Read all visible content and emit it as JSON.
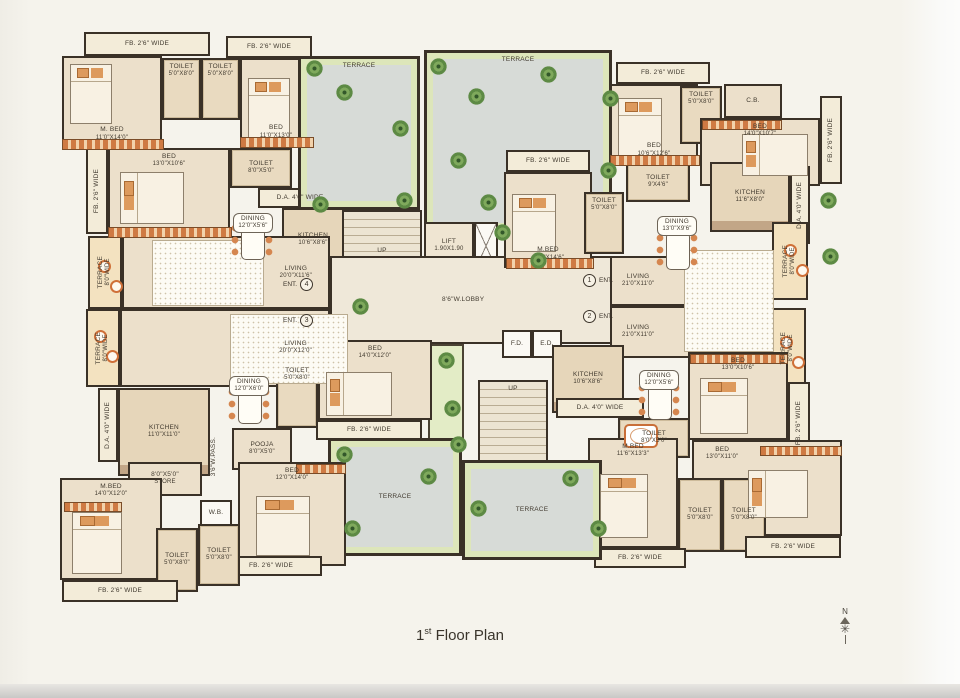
{
  "title": {
    "number": "1",
    "ordinal": "st",
    "text": " Floor Plan"
  },
  "compass": {
    "north": "N"
  },
  "colors": {
    "wall": "#3a3127",
    "floor": "#ece0cb",
    "terrace": "#d7dbd7",
    "green_trim": "#dde6ba",
    "accent": "#cf7038",
    "paper": "#f5f3ec"
  },
  "plan": {
    "rooms": [
      {
        "n": "fb-balcony",
        "a": "FB. 2'6\" WIDE",
        "x": 84,
        "y": 32,
        "w": 126,
        "h": 24,
        "k": "strip"
      },
      {
        "n": "fb-balcony",
        "a": "FB. 2'6\" WIDE",
        "x": 226,
        "y": 36,
        "w": 86,
        "h": 22,
        "k": "strip"
      },
      {
        "n": "master-bedroom",
        "a": "M. BED",
        "b": "11'0\"X14'0\"",
        "x": 62,
        "y": 56,
        "w": 100,
        "h": 92,
        "k": "room",
        "lp": "b"
      },
      {
        "n": "toilet",
        "a": "TOILET",
        "b": "5'0\"X8'0\"",
        "x": 162,
        "y": 58,
        "w": 39,
        "h": 62,
        "k": "wet",
        "lp": "t"
      },
      {
        "n": "toilet",
        "a": "TOILET",
        "b": "5'0\"X8'0\"",
        "x": 201,
        "y": 58,
        "w": 39,
        "h": 62,
        "k": "wet",
        "lp": "t"
      },
      {
        "n": "bedroom",
        "a": "BED",
        "b": "11'0\"X13'0\"",
        "x": 240,
        "y": 58,
        "w": 72,
        "h": 88,
        "k": "room",
        "lp": "b"
      },
      {
        "n": "fb-balcony",
        "a": "FB. 2'6\" WIDE",
        "x": 86,
        "y": 148,
        "w": 22,
        "h": 86,
        "k": "strip",
        "v": true
      },
      {
        "n": "bedroom",
        "a": "BED",
        "b": "13'0\"X10'6\"",
        "x": 108,
        "y": 148,
        "w": 122,
        "h": 88,
        "k": "room",
        "lp": "t"
      },
      {
        "n": "toilet",
        "a": "TOILET",
        "b": "8'0\"X5'0\"",
        "x": 230,
        "y": 148,
        "w": 62,
        "h": 40,
        "k": "wet"
      },
      {
        "n": "duct-area",
        "a": "D.A. 4'0\" WIDE",
        "x": 258,
        "y": 188,
        "w": 84,
        "h": 20,
        "k": "strip"
      },
      {
        "n": "kitchen",
        "a": "KITCHEN",
        "b": "10'6\"X8'6\"",
        "x": 282,
        "y": 208,
        "w": 62,
        "h": 64,
        "k": "kitchen"
      },
      {
        "n": "dining",
        "a": "DINING",
        "b": "12'0\"X5'6\"",
        "x": 224,
        "y": 208,
        "w": 58,
        "h": 30,
        "k": "open",
        "lb": true
      },
      {
        "n": "terrace-side",
        "a": "TERRACE",
        "b": "8'0\"WIDE",
        "x": 88,
        "y": 236,
        "w": 34,
        "h": 73,
        "k": "tstrip",
        "v": true
      },
      {
        "n": "living-room",
        "a": "LIVING",
        "b": "20'0\"X11'6\"",
        "x": 122,
        "y": 236,
        "w": 208,
        "h": 73,
        "k": "room",
        "lp": "r"
      },
      {
        "n": "terrace-side",
        "a": "TERRACE",
        "b": "8'0\"WIDE",
        "x": 86,
        "y": 309,
        "w": 34,
        "h": 78,
        "k": "tstrip",
        "v": true
      },
      {
        "n": "living-room",
        "a": "LIVING",
        "b": "20'0\"X12'0\"",
        "x": 120,
        "y": 309,
        "w": 210,
        "h": 78,
        "k": "room",
        "lp": "r"
      },
      {
        "n": "terrace",
        "a": "TERRACE",
        "x": 298,
        "y": 56,
        "w": 122,
        "h": 154,
        "k": "terrace",
        "lp": "t"
      },
      {
        "n": "terrace",
        "a": "TERRACE",
        "x": 424,
        "y": 50,
        "w": 188,
        "h": 182,
        "k": "terrace",
        "lp": "t"
      },
      {
        "n": "staircase",
        "a": "UP",
        "x": 342,
        "y": 210,
        "w": 80,
        "h": 82,
        "k": "stairs"
      },
      {
        "n": "lift",
        "a": "LIFT",
        "b": "1.90X1.90",
        "x": 424,
        "y": 222,
        "w": 50,
        "h": 48,
        "k": "lift"
      },
      {
        "n": "shaft",
        "a": "",
        "x": 474,
        "y": 222,
        "w": 24,
        "h": 48,
        "k": "shaft"
      },
      {
        "n": "lobby",
        "a": "8'6\"W.LOBBY",
        "x": 330,
        "y": 256,
        "w": 330,
        "h": 88,
        "k": "hall",
        "lp": "lob"
      },
      {
        "n": "fire-duct",
        "a": "F.D.",
        "x": 502,
        "y": 330,
        "w": 30,
        "h": 28,
        "k": "shaftl"
      },
      {
        "n": "electrical-duct",
        "a": "E.D.",
        "x": 532,
        "y": 330,
        "w": 30,
        "h": 28,
        "k": "shaftl"
      },
      {
        "n": "staircase",
        "a": "UP",
        "x": 478,
        "y": 380,
        "w": 70,
        "h": 92,
        "k": "stairs",
        "lp": "t"
      },
      {
        "n": "planter",
        "a": "",
        "x": 428,
        "y": 344,
        "w": 36,
        "h": 100,
        "k": "planter"
      },
      {
        "n": "fb-balcony",
        "a": "FB. 2'6\" WIDE",
        "x": 616,
        "y": 62,
        "w": 94,
        "h": 22,
        "k": "strip"
      },
      {
        "n": "bedroom",
        "a": "BED",
        "b": "10'6\"X12'6\"",
        "x": 610,
        "y": 84,
        "w": 88,
        "h": 80,
        "k": "room",
        "lp": "b"
      },
      {
        "n": "toilet",
        "a": "TOILET",
        "b": "5'0\"X8'0\"",
        "x": 680,
        "y": 86,
        "w": 42,
        "h": 58,
        "k": "wet",
        "lp": "t"
      },
      {
        "n": "cupboard",
        "a": "C.B.",
        "x": 724,
        "y": 84,
        "w": 58,
        "h": 34,
        "k": "room"
      },
      {
        "n": "bedroom",
        "a": "BED",
        "b": "14'0\"X10'7\"",
        "x": 700,
        "y": 118,
        "w": 120,
        "h": 68,
        "k": "room",
        "lp": "t"
      },
      {
        "n": "fb-balcony",
        "a": "FB. 2'6\" WIDE",
        "x": 820,
        "y": 96,
        "w": 22,
        "h": 88,
        "k": "strip",
        "v": true
      },
      {
        "n": "fb-balcony",
        "a": "FB. 2'6\" WIDE",
        "x": 506,
        "y": 150,
        "w": 84,
        "h": 22,
        "k": "strip"
      },
      {
        "n": "master-bedroom",
        "a": "M.BED",
        "b": "11'0\"X14'6\"",
        "x": 504,
        "y": 172,
        "w": 88,
        "h": 96,
        "k": "room",
        "lp": "b"
      },
      {
        "n": "toilet",
        "a": "TOILET",
        "b": "5'0\"X8'0\"",
        "x": 584,
        "y": 192,
        "w": 40,
        "h": 62,
        "k": "wet",
        "lp": "t"
      },
      {
        "n": "toilet",
        "a": "TOILET",
        "b": "9'X4'6\"",
        "x": 626,
        "y": 162,
        "w": 64,
        "h": 40,
        "k": "wet"
      },
      {
        "n": "kitchen",
        "a": "KITCHEN",
        "b": "11'6\"X8'0\"",
        "x": 710,
        "y": 162,
        "w": 80,
        "h": 70,
        "k": "kitchen"
      },
      {
        "n": "duct-area",
        "a": "D.A. 4'0\" WIDE",
        "x": 790,
        "y": 166,
        "w": 20,
        "h": 78,
        "k": "strip",
        "v": true
      },
      {
        "n": "dining",
        "a": "DINING",
        "b": "13'0\"X9'6\"",
        "x": 648,
        "y": 212,
        "w": 58,
        "h": 28,
        "k": "open",
        "lb": true
      },
      {
        "n": "terrace-side",
        "a": "TERRACE",
        "b": "8'0\"WIDE",
        "x": 772,
        "y": 222,
        "w": 36,
        "h": 78,
        "k": "tstrip",
        "v": true
      },
      {
        "n": "living-room",
        "a": "LIVING",
        "b": "21'0\"X11'0\"",
        "x": 610,
        "y": 256,
        "w": 162,
        "h": 50,
        "k": "room",
        "lp": "l"
      },
      {
        "n": "living-room",
        "a": "LIVING",
        "b": "21'0\"X11'0\"",
        "x": 610,
        "y": 306,
        "w": 162,
        "h": 52,
        "k": "room",
        "lp": "l"
      },
      {
        "n": "terrace-side",
        "a": "TERRACE",
        "b": "8'0\"WIDE",
        "x": 770,
        "y": 308,
        "w": 36,
        "h": 80,
        "k": "tstrip",
        "v": true
      },
      {
        "n": "kitchen",
        "a": "KITCHEN",
        "b": "10'6\"X8'6\"",
        "x": 552,
        "y": 345,
        "w": 72,
        "h": 68,
        "k": "kitchen"
      },
      {
        "n": "dining",
        "a": "DINING",
        "b": "12'0\"X5'6\"",
        "x": 630,
        "y": 366,
        "w": 58,
        "h": 28,
        "k": "open",
        "lb": true
      },
      {
        "n": "duct-area",
        "a": "D.A. 4'0\" WIDE",
        "x": 556,
        "y": 398,
        "w": 88,
        "h": 20,
        "k": "strip"
      },
      {
        "n": "toilet",
        "a": "TOILET",
        "b": "8'0\"X5'0\"",
        "x": 618,
        "y": 418,
        "w": 72,
        "h": 40,
        "k": "wet"
      },
      {
        "n": "bedroom",
        "a": "BED",
        "b": "13'0\"X10'6\"",
        "x": 688,
        "y": 352,
        "w": 100,
        "h": 88,
        "k": "room",
        "lp": "t"
      },
      {
        "n": "fb-balcony",
        "a": "FB. 2'6\" WIDE",
        "x": 788,
        "y": 382,
        "w": 22,
        "h": 82,
        "k": "strip",
        "v": true
      },
      {
        "n": "bedroom",
        "a": "BED",
        "b": "13'0\"X11'0\"",
        "x": 692,
        "y": 440,
        "w": 150,
        "h": 96,
        "k": "room",
        "lp": "tl"
      },
      {
        "n": "master-bedroom",
        "a": "M.BED",
        "b": "11'6\"X13'3\"",
        "x": 588,
        "y": 438,
        "w": 90,
        "h": 110,
        "k": "room",
        "lp": "t"
      },
      {
        "n": "toilet",
        "a": "TOILET",
        "b": "5'0\"X8'0\"",
        "x": 678,
        "y": 478,
        "w": 44,
        "h": 74,
        "k": "wet"
      },
      {
        "n": "toilet",
        "a": "TOILET",
        "b": "5'0\"X8'0\"",
        "x": 722,
        "y": 478,
        "w": 44,
        "h": 74,
        "k": "wet"
      },
      {
        "n": "fb-balcony",
        "a": "FB. 2'6\" WIDE",
        "x": 594,
        "y": 548,
        "w": 92,
        "h": 20,
        "k": "strip"
      },
      {
        "n": "fb-balcony",
        "a": "FB. 2'6\" WIDE",
        "x": 745,
        "y": 536,
        "w": 96,
        "h": 22,
        "k": "strip"
      },
      {
        "n": "terrace",
        "a": "TERRACE",
        "x": 328,
        "y": 438,
        "w": 134,
        "h": 118,
        "k": "terrace"
      },
      {
        "n": "terrace",
        "a": "TERRACE",
        "x": 462,
        "y": 460,
        "w": 140,
        "h": 100,
        "k": "terrace"
      },
      {
        "n": "bedroom",
        "a": "BED",
        "b": "14'0\"X12'0\"",
        "x": 318,
        "y": 340,
        "w": 114,
        "h": 80,
        "k": "room",
        "lp": "t"
      },
      {
        "n": "toilet",
        "a": "TOILET",
        "b": "5'0\"X8'0\"",
        "x": 276,
        "y": 362,
        "w": 42,
        "h": 66,
        "k": "wet",
        "lp": "t"
      },
      {
        "n": "fb-balcony",
        "a": "FB. 2'6\" WIDE",
        "x": 316,
        "y": 420,
        "w": 106,
        "h": 20,
        "k": "strip"
      },
      {
        "n": "dining",
        "a": "DINING",
        "b": "12'0\"X6'0\"",
        "x": 220,
        "y": 372,
        "w": 58,
        "h": 28,
        "k": "open",
        "lb": true
      },
      {
        "n": "kitchen",
        "a": "KITCHEN",
        "b": "11'0\"X11'0\"",
        "x": 118,
        "y": 388,
        "w": 92,
        "h": 88,
        "k": "kitchen"
      },
      {
        "n": "duct-area",
        "a": "D.A. 4'0\" WIDE",
        "x": 98,
        "y": 388,
        "w": 20,
        "h": 74,
        "k": "strip",
        "v": true
      },
      {
        "n": "store",
        "a": "8'0\"X5'0\"",
        "b": "STORE",
        "x": 128,
        "y": 462,
        "w": 74,
        "h": 34,
        "k": "room"
      },
      {
        "n": "passage",
        "a": "3'6\"W.PASS.",
        "x": 202,
        "y": 418,
        "w": 24,
        "h": 78,
        "k": "open",
        "v": true
      },
      {
        "n": "pooja-room",
        "a": "POOJA",
        "b": "8'0\"X5'0\"",
        "x": 232,
        "y": 428,
        "w": 60,
        "h": 42,
        "k": "room"
      },
      {
        "n": "wash-basin",
        "a": "W.B.",
        "x": 200,
        "y": 500,
        "w": 32,
        "h": 26,
        "k": "shaftl"
      },
      {
        "n": "bedroom",
        "a": "BED",
        "b": "12'0\"X14'0\"",
        "x": 238,
        "y": 462,
        "w": 108,
        "h": 104,
        "k": "room",
        "lp": "t"
      },
      {
        "n": "fb-balcony",
        "a": "FB. 2'6\" WIDE",
        "x": 220,
        "y": 556,
        "w": 102,
        "h": 20,
        "k": "strip"
      },
      {
        "n": "master-bedroom",
        "a": "M.BED",
        "b": "14'0\"X12'0\"",
        "x": 60,
        "y": 478,
        "w": 102,
        "h": 102,
        "k": "room",
        "lp": "t"
      },
      {
        "n": "toilet",
        "a": "TOILET",
        "b": "5'0\"X8'0\"",
        "x": 156,
        "y": 528,
        "w": 42,
        "h": 64,
        "k": "wet"
      },
      {
        "n": "toilet",
        "a": "TOILET",
        "b": "5'0\"X8'0\"",
        "x": 198,
        "y": 524,
        "w": 42,
        "h": 62,
        "k": "wet"
      },
      {
        "n": "fb-balcony",
        "a": "FB. 2'6\" WIDE",
        "x": 62,
        "y": 580,
        "w": 116,
        "h": 22,
        "k": "strip"
      }
    ],
    "entrances": [
      {
        "label": "ENT.",
        "num": "4",
        "x": 283,
        "y": 278,
        "circle_after": true
      },
      {
        "label": "ENT.",
        "num": "3",
        "x": 283,
        "y": 314,
        "circle_after": true
      },
      {
        "label": "ENT.",
        "num": "1",
        "x": 583,
        "y": 274,
        "circle_after": false
      },
      {
        "label": "ENT.",
        "num": "2",
        "x": 583,
        "y": 310,
        "circle_after": false
      }
    ],
    "furniture": {
      "beds": [
        {
          "x": 70,
          "y": 64,
          "w": 40,
          "h": 58,
          "o": "v"
        },
        {
          "x": 248,
          "y": 78,
          "w": 40,
          "h": 58,
          "o": "v"
        },
        {
          "x": 120,
          "y": 172,
          "w": 62,
          "h": 50,
          "o": "h"
        },
        {
          "x": 618,
          "y": 98,
          "w": 42,
          "h": 56,
          "o": "v"
        },
        {
          "x": 742,
          "y": 134,
          "w": 64,
          "h": 40,
          "o": "h"
        },
        {
          "x": 512,
          "y": 194,
          "w": 42,
          "h": 56,
          "o": "v"
        },
        {
          "x": 700,
          "y": 378,
          "w": 46,
          "h": 54,
          "o": "v"
        },
        {
          "x": 748,
          "y": 470,
          "w": 58,
          "h": 46,
          "o": "h"
        },
        {
          "x": 600,
          "y": 474,
          "w": 46,
          "h": 62,
          "o": "v"
        },
        {
          "x": 326,
          "y": 372,
          "w": 64,
          "h": 42,
          "o": "h"
        },
        {
          "x": 256,
          "y": 496,
          "w": 52,
          "h": 58,
          "o": "v"
        },
        {
          "x": 72,
          "y": 512,
          "w": 48,
          "h": 60,
          "o": "v"
        }
      ],
      "tables": [
        {
          "x": 229,
          "y": 220
        },
        {
          "x": 226,
          "y": 384
        },
        {
          "x": 654,
          "y": 230
        },
        {
          "x": 636,
          "y": 380
        }
      ],
      "rugs": [
        {
          "x": 152,
          "y": 240,
          "w": 110,
          "h": 64
        },
        {
          "x": 230,
          "y": 314,
          "w": 116,
          "h": 68
        },
        {
          "x": 684,
          "y": 250,
          "w": 88,
          "h": 100
        }
      ],
      "wardrobes": [
        {
          "x": 62,
          "y": 139,
          "w": 100,
          "h": 9
        },
        {
          "x": 108,
          "y": 227,
          "w": 122,
          "h": 9
        },
        {
          "x": 240,
          "y": 137,
          "w": 72,
          "h": 9
        },
        {
          "x": 610,
          "y": 155,
          "w": 88,
          "h": 9
        },
        {
          "x": 702,
          "y": 120,
          "w": 78,
          "h": 8
        },
        {
          "x": 506,
          "y": 258,
          "w": 86,
          "h": 9
        },
        {
          "x": 690,
          "y": 354,
          "w": 96,
          "h": 8
        },
        {
          "x": 760,
          "y": 446,
          "w": 80,
          "h": 8
        },
        {
          "x": 64,
          "y": 502,
          "w": 56,
          "h": 8
        },
        {
          "x": 296,
          "y": 464,
          "w": 48,
          "h": 8
        }
      ],
      "tubs": [
        {
          "x": 624,
          "y": 424,
          "w": 30,
          "h": 20
        }
      ],
      "chairs": [
        {
          "x": 98,
          "y": 260
        },
        {
          "x": 110,
          "y": 280
        },
        {
          "x": 94,
          "y": 330
        },
        {
          "x": 106,
          "y": 350
        },
        {
          "x": 784,
          "y": 244
        },
        {
          "x": 796,
          "y": 264
        },
        {
          "x": 780,
          "y": 336
        },
        {
          "x": 792,
          "y": 356
        }
      ]
    },
    "plants": [
      {
        "x": 306,
        "y": 60
      },
      {
        "x": 336,
        "y": 84
      },
      {
        "x": 392,
        "y": 120
      },
      {
        "x": 396,
        "y": 192
      },
      {
        "x": 312,
        "y": 196
      },
      {
        "x": 352,
        "y": 298
      },
      {
        "x": 430,
        "y": 58
      },
      {
        "x": 468,
        "y": 88
      },
      {
        "x": 540,
        "y": 66
      },
      {
        "x": 602,
        "y": 90
      },
      {
        "x": 450,
        "y": 152
      },
      {
        "x": 480,
        "y": 194
      },
      {
        "x": 600,
        "y": 162
      },
      {
        "x": 494,
        "y": 224
      },
      {
        "x": 530,
        "y": 252
      },
      {
        "x": 438,
        "y": 352
      },
      {
        "x": 444,
        "y": 400
      },
      {
        "x": 450,
        "y": 436
      },
      {
        "x": 336,
        "y": 446
      },
      {
        "x": 420,
        "y": 468
      },
      {
        "x": 344,
        "y": 520
      },
      {
        "x": 470,
        "y": 500
      },
      {
        "x": 562,
        "y": 470
      },
      {
        "x": 590,
        "y": 520
      },
      {
        "x": 820,
        "y": 192
      },
      {
        "x": 822,
        "y": 248
      }
    ]
  }
}
